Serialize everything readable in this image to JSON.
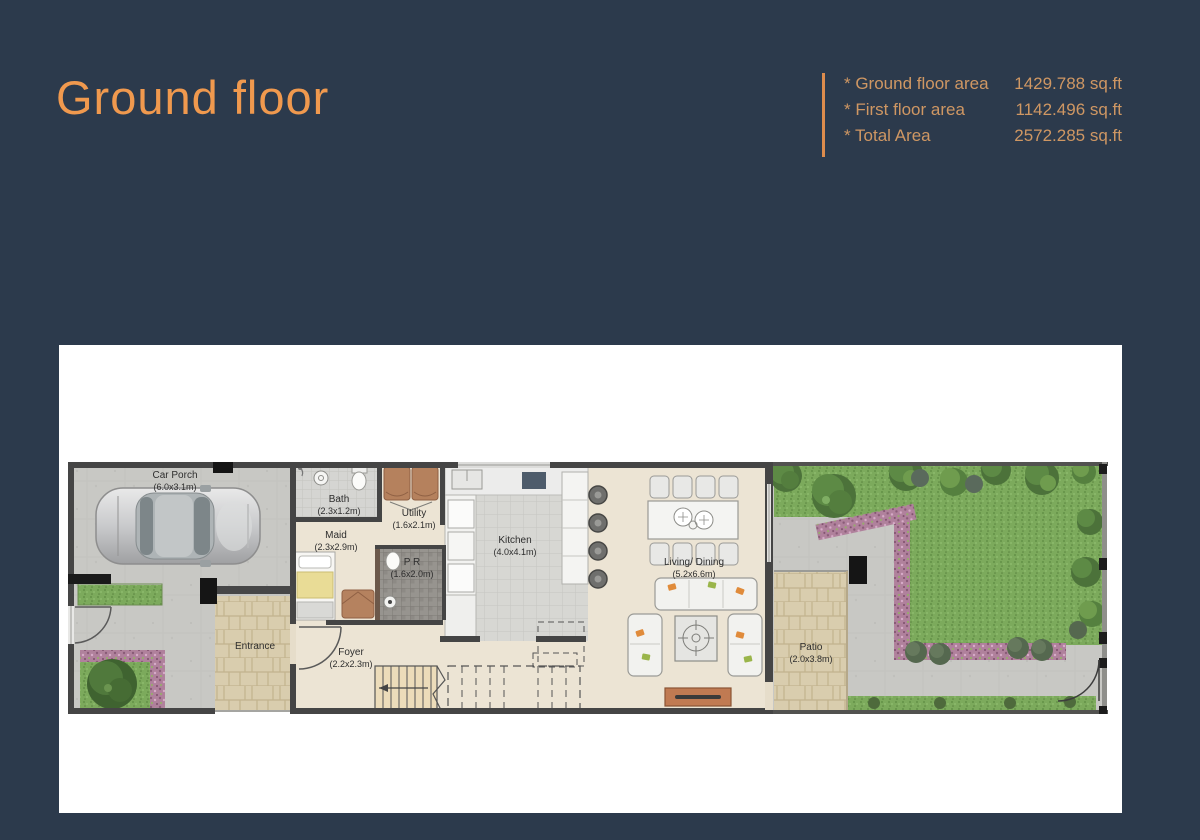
{
  "title": "Ground floor",
  "area_summary": {
    "rows": [
      {
        "label": "* Ground floor area",
        "value": "1429.788 sq.ft"
      },
      {
        "label": "* First floor area",
        "value": "1142.496 sq.ft"
      },
      {
        "label": "* Total Area",
        "value": "2572.285 sq.ft"
      }
    ]
  },
  "plan": {
    "rooms": {
      "car_porch": {
        "name": "Car Porch",
        "dims": "(6.0x3.1m)"
      },
      "bath": {
        "name": "Bath",
        "dims": "(2.3x1.2m)"
      },
      "utility": {
        "name": "Utility",
        "dims": "(1.6x2.1m)"
      },
      "maid": {
        "name": "Maid",
        "dims": "(2.3x2.9m)"
      },
      "powder_room": {
        "name": "P R",
        "dims": "(1.6x2.0m)"
      },
      "kitchen": {
        "name": "Kitchen",
        "dims": "(4.0x4.1m)"
      },
      "entrance": {
        "name": "Entrance"
      },
      "foyer": {
        "name": "Foyer",
        "dims": "(2.2x2.3m)"
      },
      "living_dining": {
        "name": "Living/ Dining",
        "dims": "(5.2x6.6m)"
      },
      "patio": {
        "name": "Patio",
        "dims": "(2.0x3.8m)"
      }
    }
  },
  "colors": {
    "background": "#2c3a4c",
    "accent": "#f0994e",
    "summary_text": "#cf9763",
    "panel": "#ffffff",
    "wall": "#454545",
    "lawn": "#7caa5c",
    "flowers": "#b0819c",
    "pavers": "#d9cdae"
  }
}
